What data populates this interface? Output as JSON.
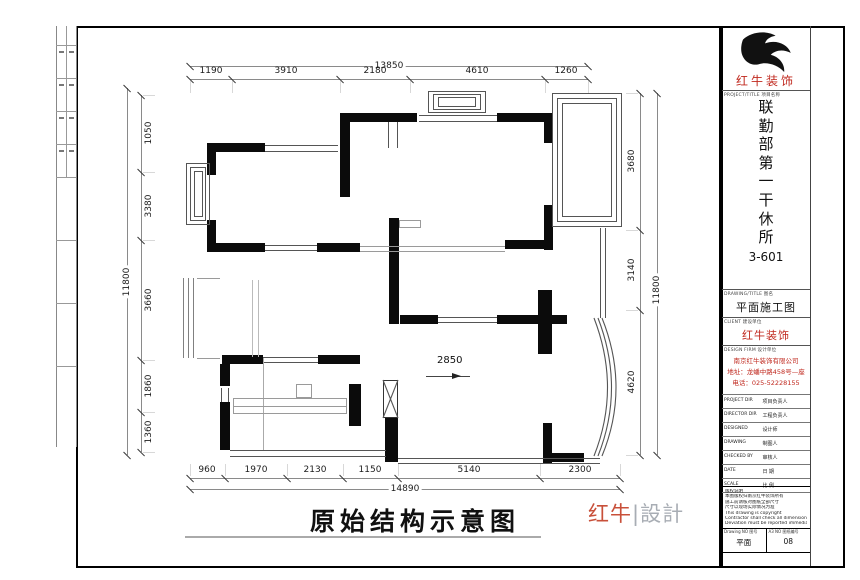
{
  "sheet": {
    "title": "原始结构示意图",
    "signature_red": "红牛",
    "signature_gray": "|設計",
    "colors": {
      "brand_red": "#c0281e",
      "signature_red": "#c8503a",
      "signature_gray": "#a8adb4",
      "wall": "#0b0b0b"
    }
  },
  "title_block": {
    "brand": "红牛装饰",
    "brand_caption": "PROJECT/TITLE 项目名称",
    "project_name": "联勤部第一干休所",
    "project_no": "3-601",
    "drawing_caption": "DRAWING/TITLE 图名",
    "drawing_title": "平面施工图",
    "client_caption": "CLIENT 建设单位",
    "client": "红牛装饰",
    "firm_caption": "DESIGN FIRM 设计单位",
    "firm_lines": [
      "南京红牛装饰有限公司",
      "地址：龙蟠中路458号—座",
      "电话：025-52228155"
    ],
    "table_rows": [
      [
        "PROJECT DIR",
        "项目负责人"
      ],
      [
        "DIRECTOR DIR",
        "工程负责人"
      ],
      [
        "DESIGNED",
        "设计师"
      ],
      [
        "DRAWING",
        "制图人"
      ],
      [
        "CHECKED BY",
        "审核人"
      ],
      [
        "DATE",
        "日 期"
      ],
      [
        "SCALE",
        "比 例"
      ]
    ],
    "notes": [
      "版权说明",
      "本图版权归南京红牛装饰所有",
      "施工前请核对图纸全部尺寸",
      "尺寸以现场实际情况为准",
      "This drawing is copyright",
      "Contractor shall check all dimensions on site",
      "Deviation must be reported immediately to architect"
    ],
    "footer": [
      {
        "caption": "Drawing NO 图号",
        "value": "平面"
      },
      {
        "caption": "A3 NO 图纸编号",
        "value": "08"
      }
    ]
  },
  "dims": [
    {
      "axis": "h",
      "y": 66,
      "a": 190,
      "b": 588,
      "ticks": [
        190,
        588
      ],
      "labels": [
        {
          "t": "13850",
          "at": 389,
          "on": true
        }
      ]
    },
    {
      "axis": "h",
      "y": 79,
      "a": 190,
      "b": 588,
      "ext": "down",
      "ticks": [
        190,
        232,
        340,
        410,
        545,
        588
      ],
      "labels": [
        {
          "t": "1190",
          "at": 211
        },
        {
          "t": "3910",
          "at": 286
        },
        {
          "t": "2180",
          "at": 375
        },
        {
          "t": "4610",
          "at": 477
        },
        {
          "t": "1260",
          "at": 566
        }
      ]
    },
    {
      "axis": "h",
      "y": 478,
      "a": 190,
      "b": 620,
      "ext": "up",
      "ticks": [
        190,
        225,
        287,
        343,
        398,
        540,
        620
      ],
      "labels": [
        {
          "t": "960",
          "at": 207
        },
        {
          "t": "1970",
          "at": 256
        },
        {
          "t": "2130",
          "at": 315
        },
        {
          "t": "1150",
          "at": 370
        },
        {
          "t": "5140",
          "at": 469
        },
        {
          "t": "2300",
          "at": 580
        }
      ]
    },
    {
      "axis": "h",
      "y": 489,
      "a": 190,
      "b": 620,
      "ticks": [
        190,
        620
      ],
      "labels": [
        {
          "t": "14890",
          "at": 405,
          "on": true
        }
      ]
    },
    {
      "axis": "v",
      "x": 127,
      "a": 88,
      "b": 455,
      "ticks": [
        88,
        455
      ],
      "labels": [
        {
          "t": "11800",
          "at": 282,
          "on": true
        }
      ]
    },
    {
      "axis": "v",
      "x": 141,
      "a": 95,
      "b": 452,
      "ext": "right",
      "side": "right",
      "ticks": [
        95,
        172,
        240,
        360,
        412,
        452
      ],
      "labels": [
        {
          "t": "1050",
          "at": 133
        },
        {
          "t": "3380",
          "at": 206
        },
        {
          "t": "3660",
          "at": 300
        },
        {
          "t": "1860",
          "at": 386
        },
        {
          "t": "1360",
          "at": 432
        }
      ]
    },
    {
      "axis": "v",
      "x": 640,
      "a": 93,
      "b": 455,
      "ext": "left",
      "side": "left",
      "ticks": [
        93,
        230,
        310,
        455
      ],
      "labels": [
        {
          "t": "3680",
          "at": 161
        },
        {
          "t": "3140",
          "at": 270
        },
        {
          "t": "4620",
          "at": 382
        }
      ]
    },
    {
      "axis": "v",
      "x": 657,
      "a": 93,
      "b": 455,
      "ticks": [
        93,
        455
      ],
      "labels": [
        {
          "t": "11800",
          "at": 290,
          "on": true
        }
      ]
    }
  ],
  "plan": {
    "walls": [
      [
        207,
        143,
        58,
        9
      ],
      [
        340,
        113,
        10,
        84
      ],
      [
        347,
        113,
        70,
        9
      ],
      [
        497,
        113,
        48,
        9
      ],
      [
        544,
        113,
        9,
        30
      ],
      [
        207,
        143,
        9,
        32
      ],
      [
        207,
        220,
        9,
        32
      ],
      [
        207,
        243,
        58,
        9
      ],
      [
        317,
        243,
        43,
        9
      ],
      [
        505,
        240,
        40,
        9
      ],
      [
        544,
        205,
        9,
        45
      ],
      [
        389,
        218,
        10,
        106
      ],
      [
        400,
        315,
        38,
        9
      ],
      [
        497,
        315,
        70,
        9
      ],
      [
        538,
        290,
        14,
        64
      ],
      [
        222,
        355,
        41,
        9
      ],
      [
        318,
        355,
        42,
        9
      ],
      [
        220,
        364,
        10,
        22
      ],
      [
        220,
        402,
        10,
        48
      ],
      [
        349,
        384,
        12,
        42
      ],
      [
        385,
        418,
        13,
        44
      ],
      [
        543,
        423,
        9,
        40
      ],
      [
        543,
        453,
        41,
        9
      ]
    ],
    "lines": [
      [
        265,
        145,
        73,
        "h"
      ],
      [
        265,
        151,
        73,
        "h"
      ],
      [
        419,
        115,
        78,
        "h"
      ],
      [
        419,
        121,
        78,
        "h"
      ],
      [
        265,
        245,
        52,
        "h"
      ],
      [
        265,
        250,
        52,
        "h"
      ],
      [
        360,
        246,
        145,
        "h",
        "#9a9a9a"
      ],
      [
        360,
        251,
        145,
        "h",
        "#9a9a9a"
      ],
      [
        438,
        317,
        59,
        "h"
      ],
      [
        438,
        322,
        59,
        "h"
      ],
      [
        263,
        357,
        55,
        "h"
      ],
      [
        263,
        362,
        55,
        "h"
      ],
      [
        230,
        450,
        156,
        "h"
      ],
      [
        230,
        456,
        156,
        "h"
      ],
      [
        398,
        458,
        202,
        "h"
      ],
      [
        398,
        463,
        202,
        "h"
      ],
      [
        388,
        122,
        26,
        "v"
      ],
      [
        397,
        122,
        26,
        "v"
      ],
      [
        600,
        228,
        90,
        "v"
      ],
      [
        605,
        228,
        90,
        "v"
      ],
      [
        183,
        278,
        80,
        "v",
        "#808080"
      ],
      [
        188,
        278,
        80,
        "v",
        "#808080"
      ],
      [
        193,
        278,
        80,
        "v",
        "#808080"
      ],
      [
        197,
        278,
        23,
        "h",
        "#9a9a9a"
      ],
      [
        197,
        358,
        23,
        "h",
        "#9a9a9a"
      ],
      [
        221,
        388,
        14,
        "v"
      ],
      [
        228,
        388,
        14,
        "v"
      ],
      [
        252,
        280,
        77,
        "v",
        "#bbbbbb"
      ],
      [
        258,
        280,
        77,
        "v",
        "#bbbbbb"
      ],
      [
        263,
        358,
        92,
        "v",
        "#aaaaaa"
      ],
      [
        233,
        406,
        114,
        "h",
        "#9a9a9a"
      ]
    ],
    "outlines": [
      [
        186,
        163,
        24,
        62
      ],
      [
        190,
        167,
        16,
        54
      ],
      [
        194,
        171,
        9,
        46
      ],
      [
        428,
        91,
        58,
        22
      ],
      [
        433,
        94,
        48,
        16
      ],
      [
        438,
        97,
        38,
        10
      ],
      [
        552,
        93,
        70,
        134
      ],
      [
        557,
        98,
        60,
        124
      ],
      [
        562,
        103,
        50,
        114
      ],
      [
        233,
        398,
        114,
        16,
        "#9a9a9a"
      ],
      [
        296,
        384,
        16,
        14,
        "#9a9a9a"
      ],
      [
        399,
        220,
        22,
        8,
        "#9a9a9a"
      ],
      [
        383,
        380,
        15,
        38,
        "#333333"
      ]
    ],
    "curves": [
      "M602,318 Q630,388 602,456",
      "M598,318 Q625,388 598,456",
      "M594,318 Q621,388 594,456",
      "M383,380 L398,418",
      "M398,380 L383,418"
    ],
    "annotation": {
      "text": "2850",
      "tx": 437,
      "ty": 355,
      "lx": 426,
      "ly": 376,
      "llen": 44,
      "ax": 452,
      "ay": 373
    },
    "strip": {
      "x1": 56,
      "x2": 76,
      "mid": 66,
      "y1": 26,
      "y2": 447,
      "dividers": [
        45,
        78,
        111,
        144,
        177,
        240,
        303,
        366
      ],
      "marked_cells": [
        46,
        79,
        112,
        145
      ]
    }
  }
}
